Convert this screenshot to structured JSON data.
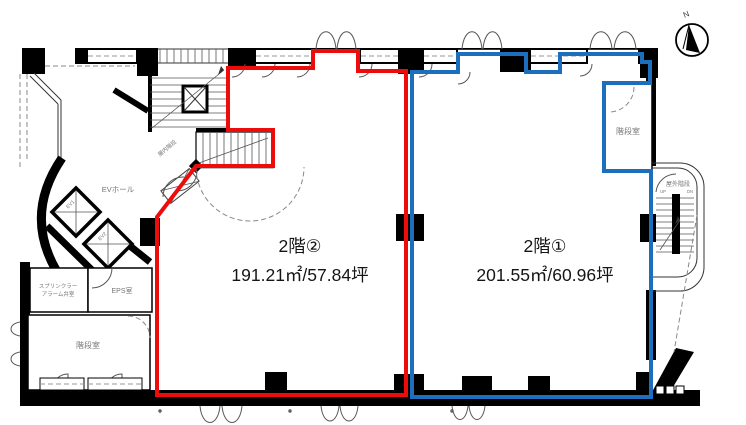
{
  "compass": {
    "label": "N"
  },
  "colors": {
    "zone1_blue": "#1e6ebe",
    "zone2_red": "#ee0b0b",
    "wall": "#000000"
  },
  "zones": {
    "zone1": {
      "label": "2階①",
      "area": "201.55㎡/60.96坪"
    },
    "zone2": {
      "label": "2階②",
      "area": "191.21㎡/57.84坪"
    }
  },
  "rooms": {
    "stair_left": "階段室",
    "stair_right": "階段室",
    "outdoor_stair": "屋外階段",
    "inner_stair": "屋内階段",
    "ev_hall": "EVホール",
    "eps": "EPS室",
    "sprinkler_line1": "スプリンクラー",
    "sprinkler_line2": "アラーム弁室",
    "ev1": "EV1",
    "ev2": "EV2",
    "up": "UP",
    "dn": "DN"
  }
}
